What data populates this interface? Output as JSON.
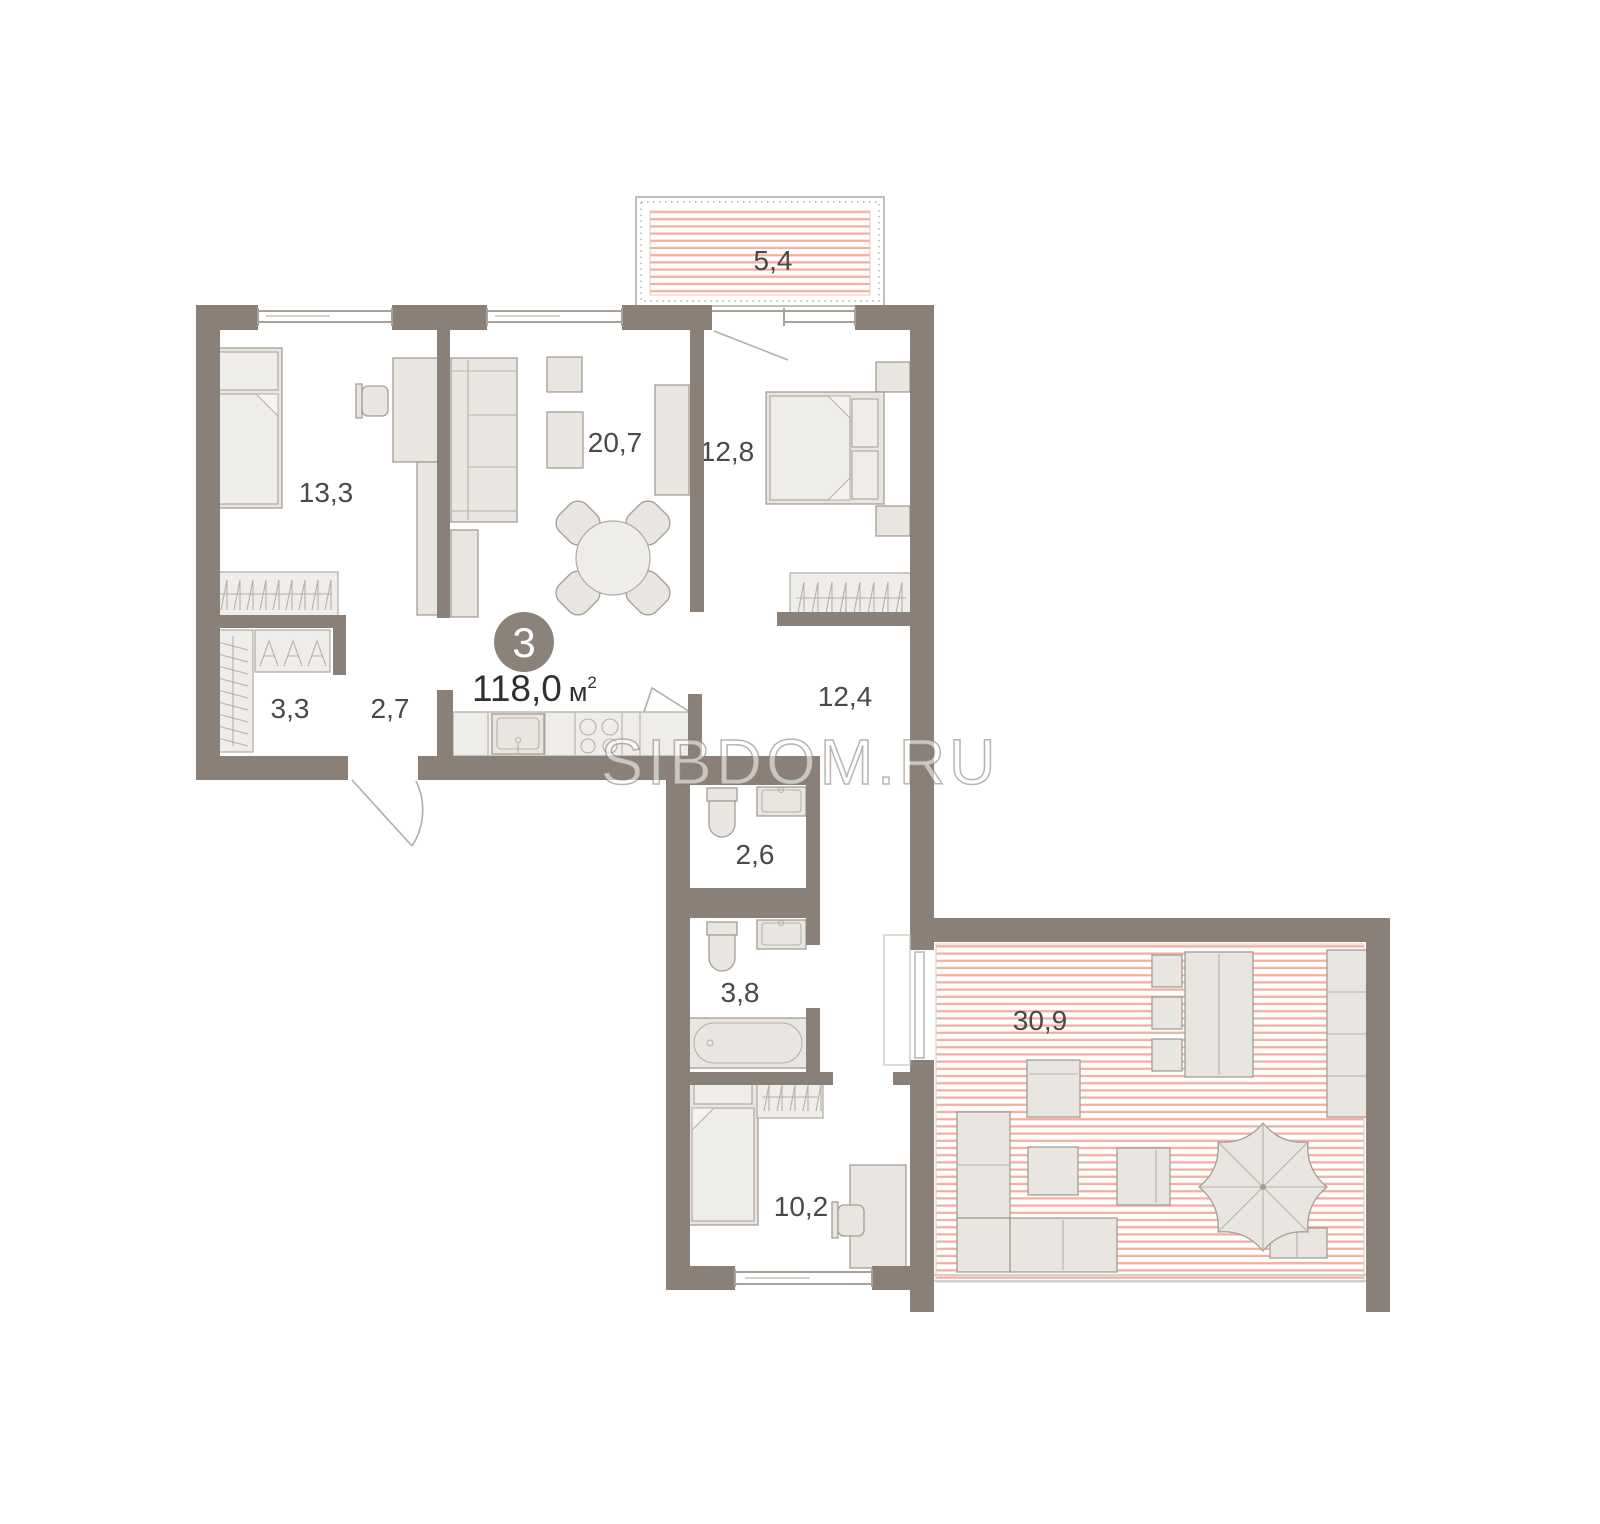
{
  "plan": {
    "badge_number": "3",
    "total_area_value": "118,0",
    "total_area_unit": "м",
    "total_area_sup": "2",
    "watermark_text": "SIBDOM.RU",
    "rooms": [
      {
        "name": "balcony",
        "area_label": "5,4"
      },
      {
        "name": "bedroom-top-left",
        "area_label": "13,3"
      },
      {
        "name": "living-room",
        "area_label": "20,7"
      },
      {
        "name": "bedroom-top-right",
        "area_label": "12,8"
      },
      {
        "name": "walk-in-closet",
        "area_label": "3,3"
      },
      {
        "name": "hallway",
        "area_label": "2,7"
      },
      {
        "name": "corridor",
        "area_label": "12,4"
      },
      {
        "name": "wc",
        "area_label": "2,6"
      },
      {
        "name": "bathroom",
        "area_label": "3,8"
      },
      {
        "name": "bedroom-bottom",
        "area_label": "10,2"
      },
      {
        "name": "terrace",
        "area_label": "30,9"
      }
    ],
    "colors": {
      "wall": "#8a8078",
      "furniture_fill": "#e9e6e1",
      "furniture_stroke": "#a39d94",
      "stripe_red": "#f3afa0",
      "label_text": "#4b4845",
      "badge_fill": "#8b8379",
      "badge_text": "#ffffff",
      "watermark_gray": "#908a82"
    }
  }
}
